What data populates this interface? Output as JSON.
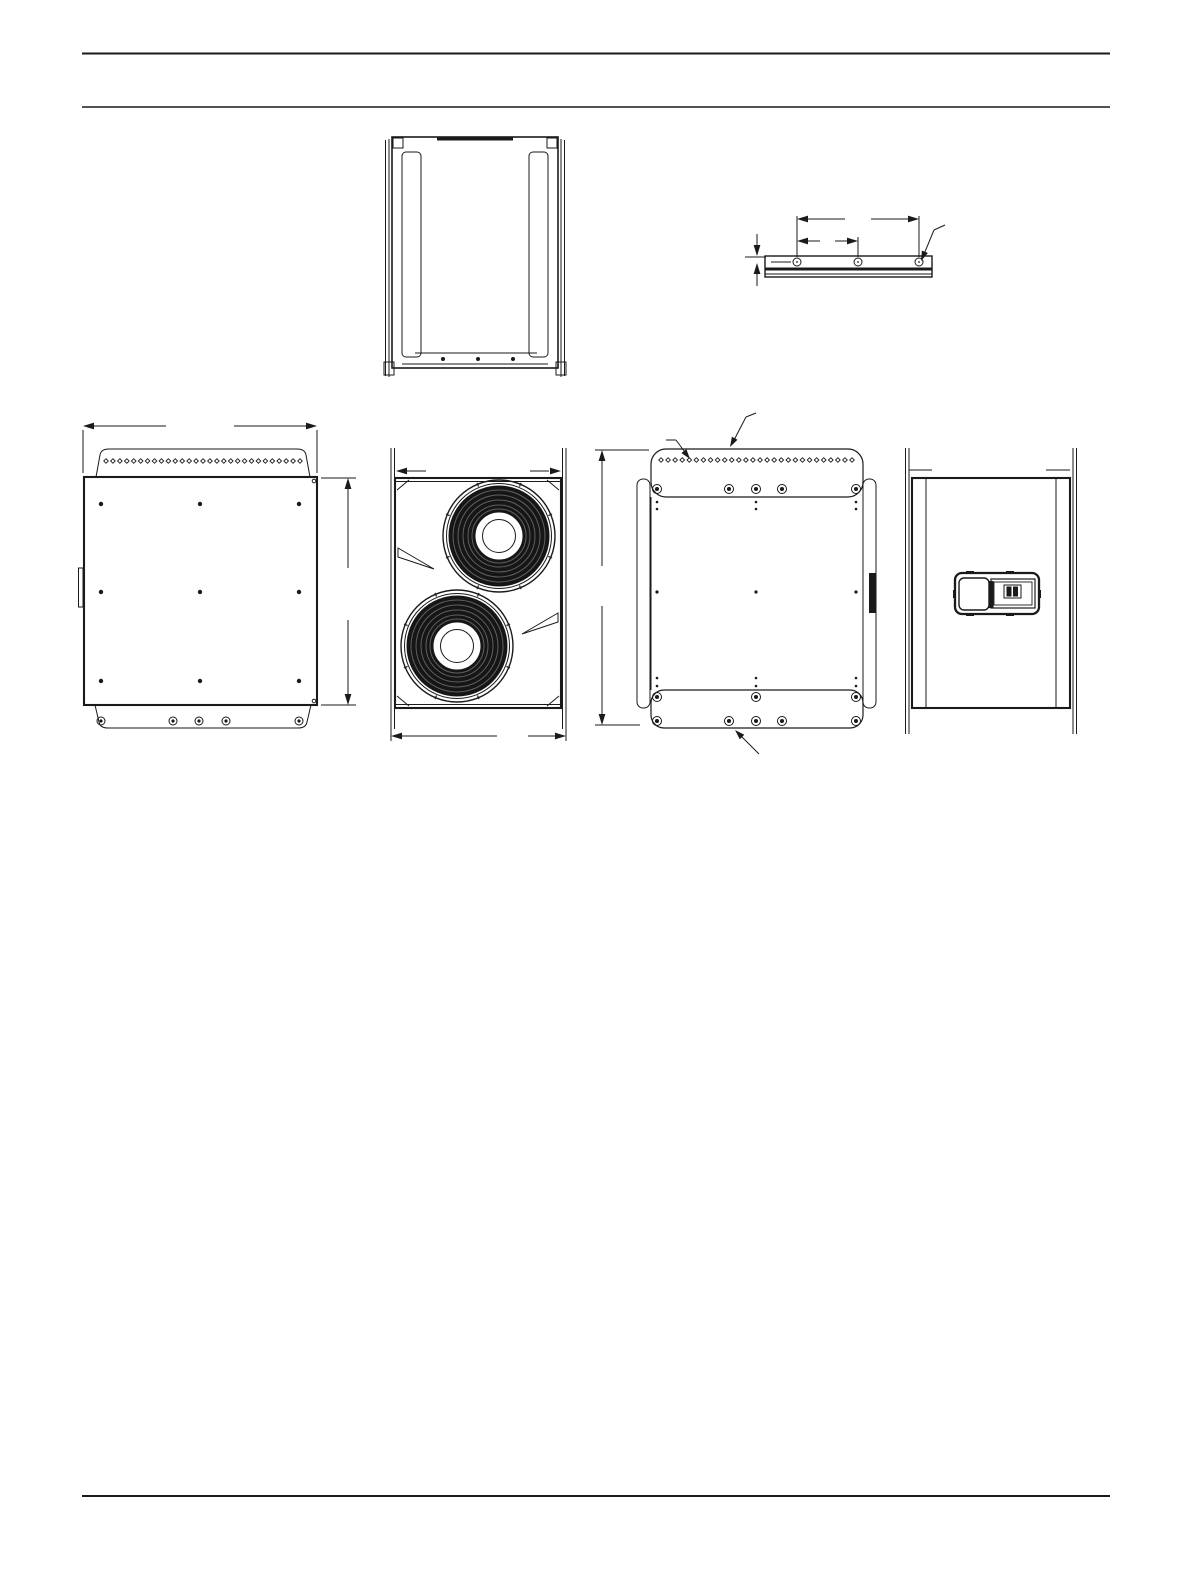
{
  "page": {
    "background": "#ffffff",
    "ink": "#1a1a1a",
    "woofer_fill": "#161616",
    "woofer_ring": "#606060"
  },
  "views": [
    "top-view",
    "mounting-rail-detail",
    "side-view-left",
    "front-view",
    "rear-view",
    "side-view-right"
  ],
  "patterns": {
    "top_view_dots": {
      "type": "dots",
      "xs": [
        443,
        478,
        513
      ],
      "ys": [
        359
      ],
      "r": 2
    },
    "rail_holes": {
      "type": "screws",
      "xs": [
        797,
        858,
        919
      ],
      "y": 262,
      "r": 4,
      "dot": 0.22
    },
    "side_left_diamonds": {
      "type": "diamond-row",
      "count": 29,
      "x0": 106,
      "x1": 300,
      "y": 461,
      "size": 4.6
    },
    "side_left_dots": {
      "type": "dots",
      "xs": [
        101,
        200,
        299
      ],
      "ys": [
        504,
        592,
        681
      ],
      "r": 2.2
    },
    "side_left_screws": {
      "type": "screws",
      "xs": [
        101,
        173,
        199,
        226,
        299
      ],
      "y": 721,
      "r": 4,
      "dot": 0.4
    },
    "rear_diamonds": {
      "type": "diamond-row",
      "count": 28,
      "x0": 661,
      "x1": 852,
      "y": 460,
      "size": 4.6
    },
    "rear_screws_top": {
      "type": "screws",
      "xs": [
        657,
        729,
        756,
        782,
        856
      ],
      "y": 489,
      "r": 4.5,
      "dot": 0.45
    },
    "rear_dots_upper": {
      "type": "dots",
      "xs": [
        657,
        756,
        856
      ],
      "ys": [
        502,
        509
      ],
      "r": 1.3
    },
    "rear_dots_mid": {
      "type": "dots",
      "xs": [
        657,
        756,
        856
      ],
      "ys": [
        592
      ],
      "r": 1.6
    },
    "rear_dots_lower": {
      "type": "dots",
      "xs": [
        657,
        756,
        856
      ],
      "ys": [
        678,
        686
      ],
      "r": 1.3
    },
    "rear_screws_bottom_1": {
      "type": "screws",
      "xs": [
        657,
        756,
        856
      ],
      "y": 697,
      "r": 4.5,
      "dot": 0.45
    },
    "rear_screws_bottom_2": {
      "type": "screws",
      "xs": [
        657,
        729,
        756,
        782,
        856
      ],
      "y": 721,
      "r": 4.5,
      "dot": 0.45
    },
    "woofers": {
      "type": "woofers",
      "centers": [
        [
          499,
          536
        ],
        [
          457,
          646
        ]
      ],
      "r_outer": 56,
      "r_frame": 52.5,
      "r_cone": 50.5,
      "rings": [
        46,
        41,
        36,
        31,
        27
      ],
      "r_cap": 24,
      "r_cap_inner": 16.5,
      "tick_count": 8
    }
  }
}
